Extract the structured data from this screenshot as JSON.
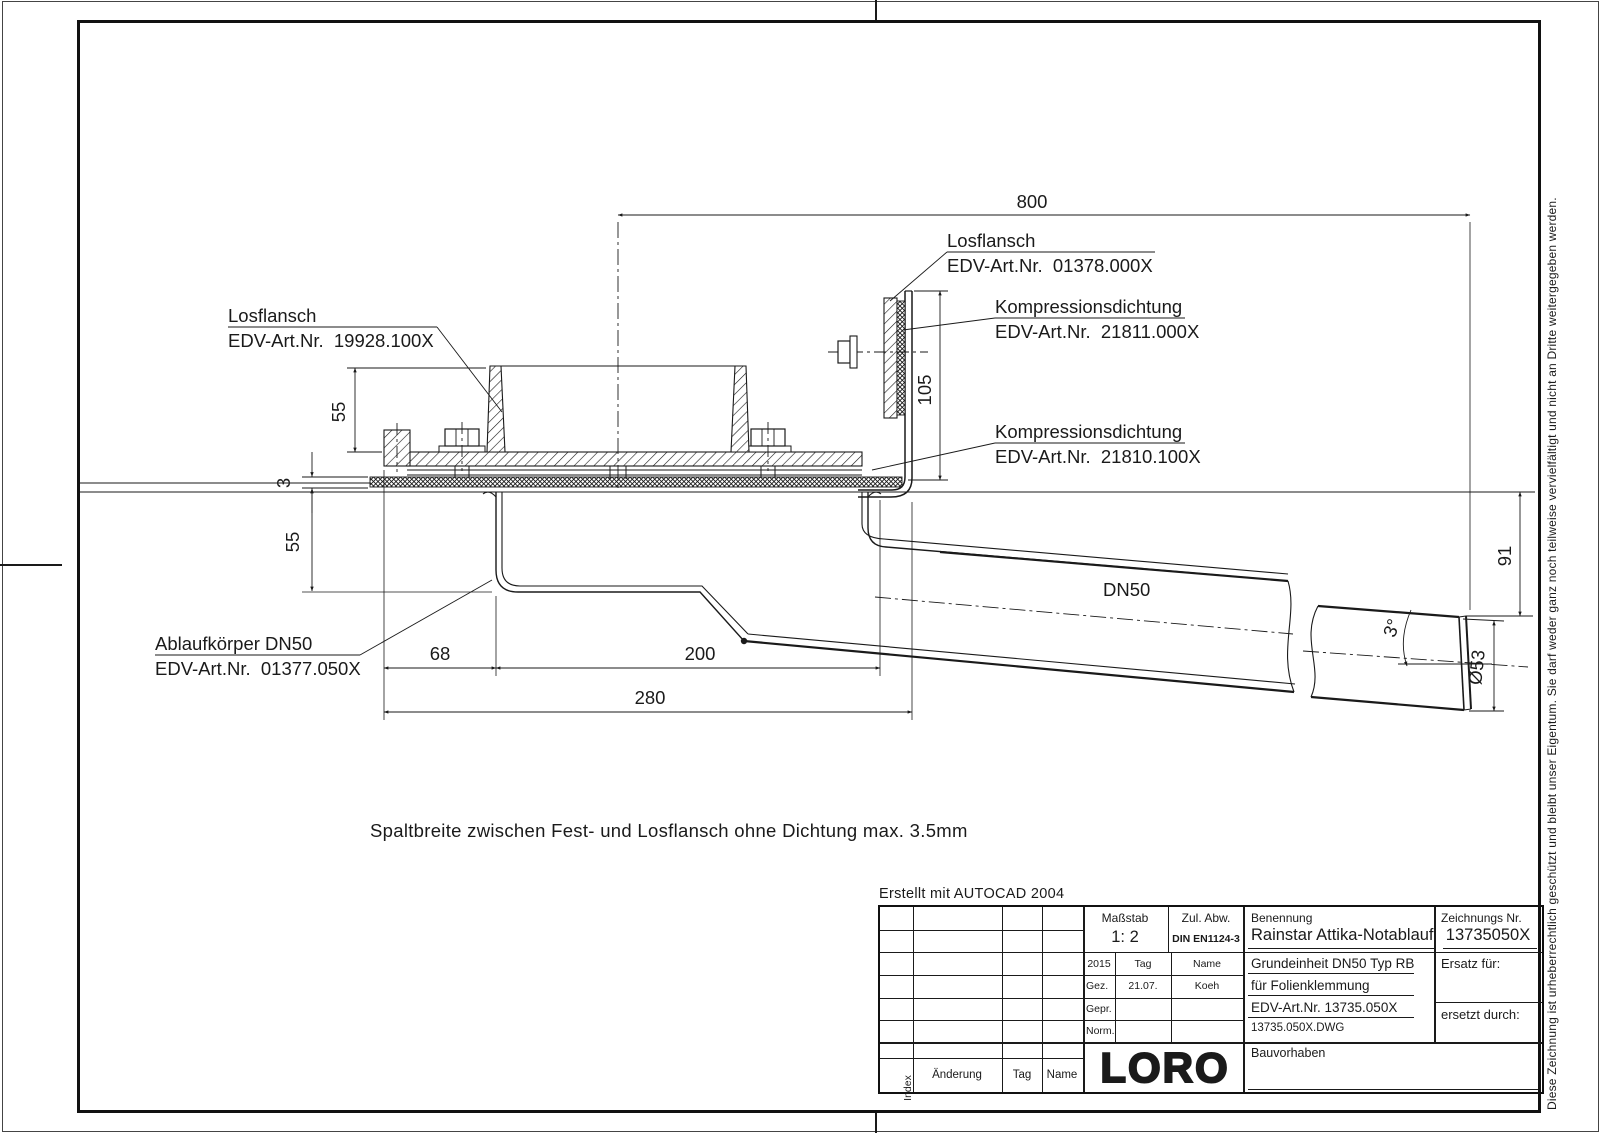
{
  "frame": {
    "created_with": "Erstellt mit AUTOCAD 2004",
    "copyright": "Diese Zeichnung ist urheberrechtlich geschützt und bleibt unser Eigentum. Sie darf weder ganz noch teilweise vervielfältigt und nicht an Dritte weitergegeben werden."
  },
  "note": "Spaltbreite zwischen Fest- und Losflansch ohne Dichtung max. 3.5mm",
  "labels": {
    "losflansch_left": {
      "line1": "Losflansch",
      "line2": "EDV-Art.Nr.  19928.100X"
    },
    "losflansch_right": {
      "line1": "Losflansch",
      "line2": "EDV-Art.Nr.  01378.000X"
    },
    "kompression_top": {
      "line1": "Kompressionsdichtung",
      "line2": "EDV-Art.Nr.  21811.000X"
    },
    "kompression_bottom": {
      "line1": "Kompressionsdichtung",
      "line2": "EDV-Art.Nr.  21810.100X"
    },
    "ablaufkoerper": {
      "line1": "Ablaufkörper DN50",
      "line2": "EDV-Art.Nr.  01377.050X"
    },
    "pipe": "DN50"
  },
  "dimensions": {
    "total_width": "800",
    "wall_height": "105",
    "flange_height": "55",
    "membrane_thickness": "3",
    "body_depth": "55",
    "outlet_drop": "91",
    "edge_offset": "68",
    "body_length": "200",
    "overall_length": "280",
    "pipe_diameter": "Ø53",
    "pipe_slope": "3°"
  },
  "title_block": {
    "massstab_label": "Maßstab",
    "massstab_value": "1: 2",
    "zul_abw_label": "Zul. Abw.",
    "zul_abw_value": "DIN EN1124-3",
    "benennung_label": "Benennung",
    "benennung_value": "Rainstar Attika-Notablauf",
    "zeichnungs_label": "Zeichnungs Nr.",
    "zeichnungs_value": "13735050X",
    "year": "2015",
    "tag_header": "Tag",
    "name_header": "Name",
    "gez_label": "Gez.",
    "gez_date": "21.07.",
    "gez_name": "Koeh",
    "gepr_label": "Gepr.",
    "norm_label": "Norm.",
    "desc_line1": "Grundeinheit DN50 Typ RB",
    "desc_line2": "für Folienklemmung",
    "desc_line3": "EDV-Art.Nr. 13735.050X",
    "desc_line4": "13735.050X.DWG",
    "ersatz_label": "Ersatz für:",
    "ersetzt_label": "ersetzt durch:",
    "bauvorhaben_label": "Bauvorhaben",
    "logo": "LORO",
    "index_col": "Index",
    "aenderung_col": "Änderung",
    "tag_col": "Tag",
    "name_col": "Name"
  }
}
